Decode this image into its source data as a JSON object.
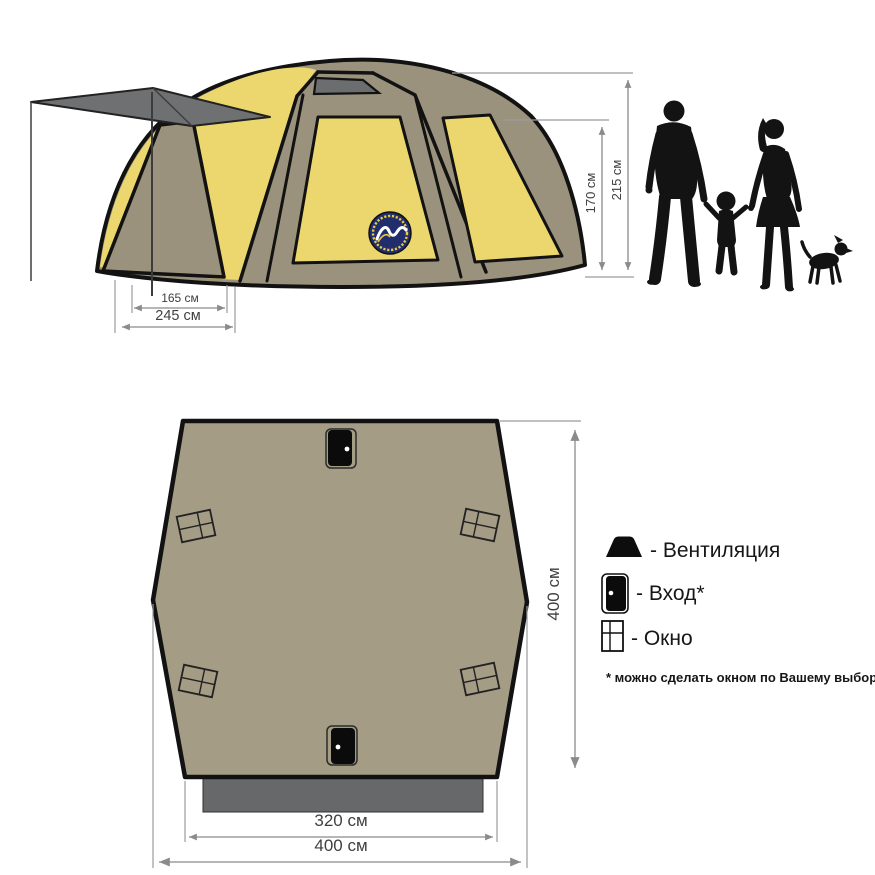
{
  "side_view": {
    "dim_inner_base": "165 см",
    "dim_outer_base": "245 см",
    "dim_wall_height": "170 см",
    "dim_total_height": "215 см"
  },
  "floor_plan": {
    "dim_inner_width": "320 см",
    "dim_outer_width": "400 см",
    "dim_depth": "400 см"
  },
  "legend": {
    "items": [
      {
        "icon": "vent-icon",
        "label": "- Вентиляция"
      },
      {
        "icon": "door-icon",
        "label": "- Вход*"
      },
      {
        "icon": "window-icon",
        "label": "- Окно"
      }
    ],
    "footnote": "* можно сделать окном по Вашему выбору"
  },
  "colors": {
    "tent_yellow": "#ecd76e",
    "tent_khaki": "#9a927c",
    "plan_fill": "#a49c84",
    "awning_gray": "#6f7072",
    "vestibule_gray": "#67686a",
    "dimension_gray": "#8a8b8d",
    "logo_navy": "#202e6d"
  }
}
